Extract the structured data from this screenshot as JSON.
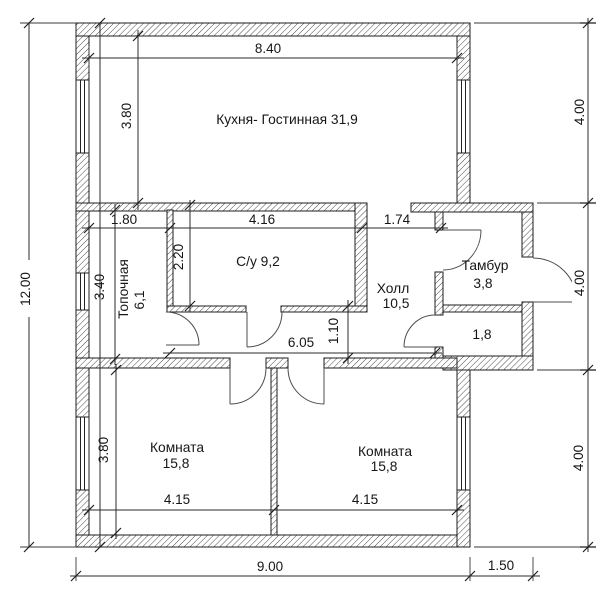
{
  "drawing": {
    "type": "floor-plan",
    "rooms": {
      "kitchen_living": {
        "label": "Кухня- Гостинная 31,9"
      },
      "boiler": {
        "name": "Топочная",
        "area": "6,1"
      },
      "bathroom": {
        "label": "С/у 9,2"
      },
      "hall": {
        "name": "Холл",
        "area": "10,5"
      },
      "vestibule": {
        "name": "Тамбур",
        "area": "3,8"
      },
      "storage": {
        "area": "1,8"
      },
      "bedroom_left": {
        "name": "Комната",
        "area": "15,8"
      },
      "bedroom_right": {
        "name": "Комната",
        "area": "15,8"
      }
    },
    "dims": {
      "total_height": "12.00",
      "top_width": "8.40",
      "right_top": "4.00",
      "right_middle": "4.00",
      "right_bottom": "4.00",
      "bottom_width": "9.00",
      "bottom_porch": "1.50",
      "kitchen_depth": "3.80",
      "boiler_width": "1.80",
      "bath_width": "4.16",
      "hall_top_width": "1.74",
      "bath_depth": "2.20",
      "boiler_depth": "3.40",
      "corridor_length": "6.05",
      "corridor_width": "1.10",
      "bedroom_depth": "3.80",
      "bedroom_left_width": "4.15",
      "bedroom_right_width": "4.15"
    },
    "colors": {
      "ink": "#1c1c1c",
      "paper": "#ffffff"
    }
  }
}
